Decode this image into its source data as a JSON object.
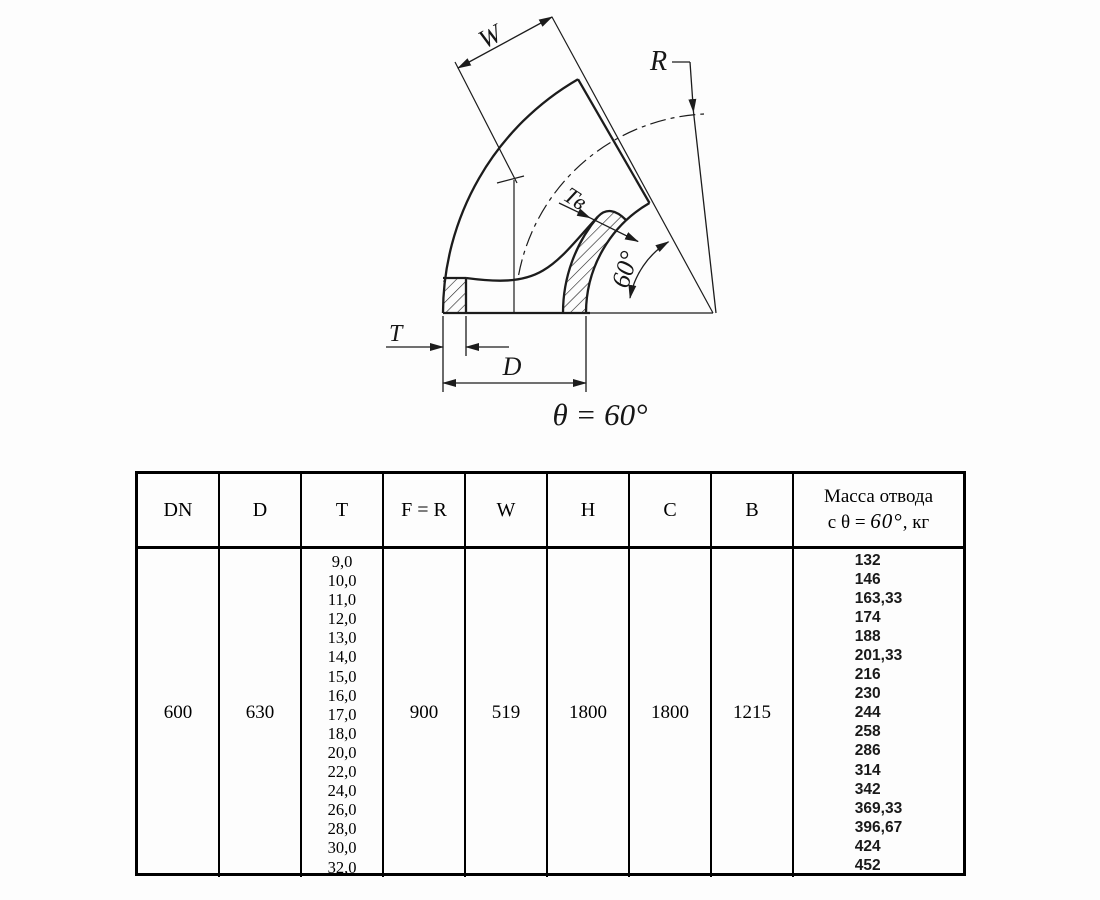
{
  "diagram": {
    "label_w": "W",
    "label_r": "R",
    "label_tv": "Тв",
    "label_t": "T",
    "label_d": "D",
    "label_angle": "60°",
    "caption": "θ = 60°"
  },
  "table": {
    "headers": [
      "DN",
      "D",
      "T",
      "F = R",
      "W",
      "H",
      "C",
      "B"
    ],
    "mass_header": {
      "line1": "Масса отвода",
      "prefix": "с θ = ",
      "angle": "60°",
      "suffix": ", кг"
    },
    "row": {
      "dn": "600",
      "d": "630",
      "t_values": [
        "9,0",
        "10,0",
        "11,0",
        "12,0",
        "13,0",
        "14,0",
        "15,0",
        "16,0",
        "17,0",
        "18,0",
        "20,0",
        "22,0",
        "24,0",
        "26,0",
        "28,0",
        "30,0",
        "32,0"
      ],
      "f_r": "900",
      "w": "519",
      "h": "1800",
      "c": "1800",
      "b": "1215",
      "mass_values": [
        "132",
        "146",
        "163,33",
        "174",
        "188",
        "201,33",
        "216",
        "230",
        "244",
        "258",
        "286",
        "314",
        "342",
        "369,33",
        "396,67",
        "424",
        "452"
      ]
    }
  }
}
